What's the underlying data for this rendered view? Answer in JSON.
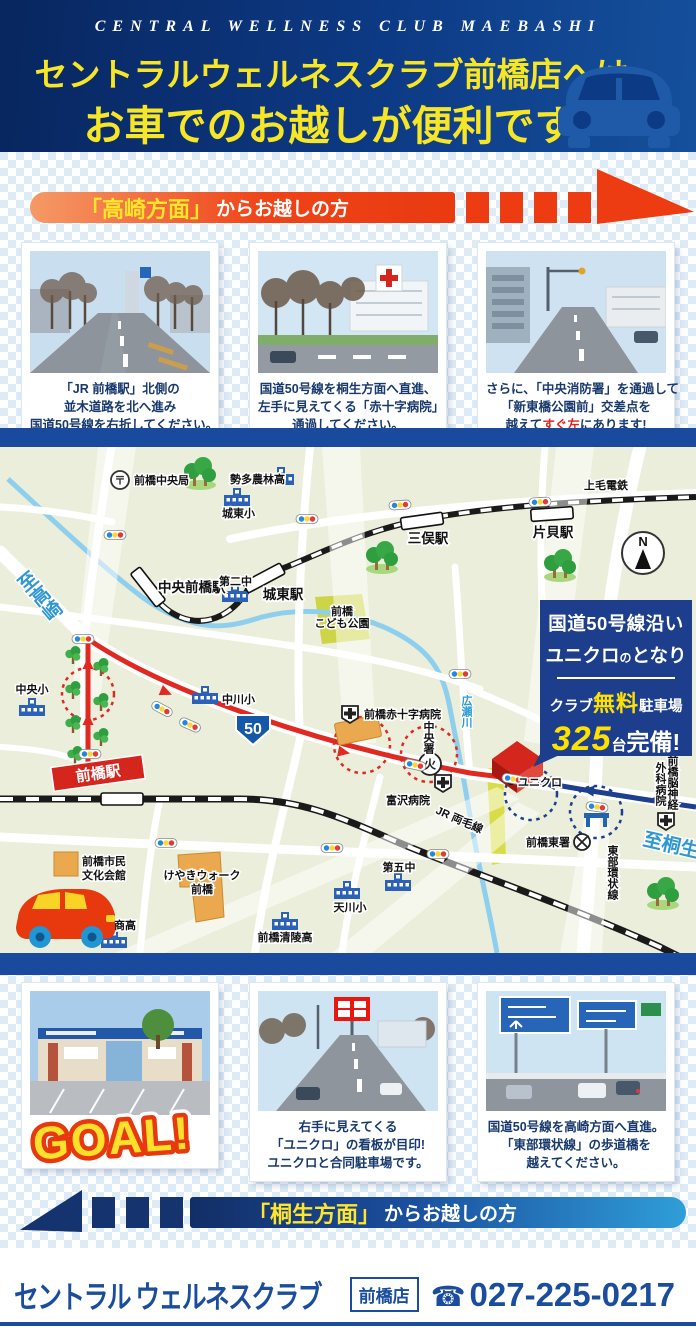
{
  "header": {
    "english": "CENTRAL WELLNESS CLUB MAEBASHI",
    "line1": "セントラルウェルネスクラブ前橋店へは、",
    "line2": "お車でのお越しが便利です。"
  },
  "takasaki": {
    "kicker": "「高崎方面」",
    "rest": "からお越しの方",
    "steps": [
      {
        "l1": "「JR 前橋駅」北側の",
        "l2": "並木道路を北へ進み",
        "l3": "国道50号線を右折してください。"
      },
      {
        "l1": "国道50号線を桐生方面へ直進、",
        "l2": "左手に見えてくる「赤十字病院」",
        "l3": "通過してください。"
      },
      {
        "l1": "さらに、「中央消防署」を通過して",
        "l2": "「新東橋公園前」交差点を",
        "l3_pre": "越えて",
        "l3_em": "すぐ左",
        "l3_post": "にあります!"
      }
    ]
  },
  "kiryu": {
    "kicker": "「桐生方面」",
    "rest": "からお越しの方",
    "goal": "GOAL!",
    "steps": [
      {
        "l1": "右手に見えてくる",
        "l2": "「ユニクロ」の看板が目印!",
        "l3": "ユニクロと合同駐車場です。"
      },
      {
        "l1": "国道50号線を高崎方面へ直進。",
        "l2": "「東部環状線」の歩道橋を",
        "l3": "越えてください。"
      }
    ]
  },
  "map": {
    "post_mark": "〒",
    "post_office": "前橋中央局",
    "seta_norin_high": "勢多農林高",
    "joto_elementary": "城東小",
    "chuo_maebashi_station": "中央前橋駅",
    "daini_junior_high": "第二中",
    "joto_station": "城東駅",
    "mitsumata_station": "三俣駅",
    "katakai_station": "片貝駅",
    "jomo_dentetsu": "上毛電鉄",
    "kodomo_park_line1": "前橋",
    "kodomo_park_line2": "こども公園",
    "to_takasaki": "至高崎",
    "chuo_elementary": "中央小",
    "nakagawa_elementary": "中川小",
    "route50_number": "50",
    "red_cross_hospital": "前橋赤十字病院",
    "chuo_fire_station": "中央署",
    "fire_mark": "火",
    "tomizawa_hospital": "富沢病院",
    "hirose_river": "広瀬川",
    "maebashi_station": "前橋駅",
    "uniqlo": "ユニクロ",
    "jr_ryomo_line": "JR 両毛線",
    "maebashi_higashi_police": "前橋東署",
    "tobu_ring_road": "東部環状線",
    "to_kiryu": "至桐生",
    "neuro_hospital_line1": "前橋脳神経",
    "neuro_hospital_line2": "外科病院",
    "daigo_junior_high": "第五中",
    "amagawa_elementary": "天川小",
    "seiryo_high": "前橋清陵高",
    "shogyo_high": "前橋商高",
    "bunka_kaikan_line1": "前橋市民",
    "bunka_kaikan_line2": "文化会館",
    "keyaki_walk_line1": "けやきウォーク",
    "keyaki_walk_line2": "前橋",
    "compass_n": "N",
    "info_box": {
      "line1": "国道50号線沿い",
      "line2a": "ユニクロ",
      "line2b": "の",
      "line2c": "となり",
      "p1": "クラブ",
      "p2": "無料",
      "p3": "駐車場",
      "c1": "325",
      "c2": "台",
      "c3": "完備!"
    }
  },
  "footer": {
    "logo": "セントラル ウェルネスクラブ",
    "branch": "前橋店",
    "phone_icon": "☎",
    "phone": "027-225-0217"
  },
  "colors": {
    "brand_blue": "#1a4d9e",
    "banner_red": "#ee3c12",
    "accent_yellow": "#f7e625",
    "map_bg": "#eaeedb"
  }
}
